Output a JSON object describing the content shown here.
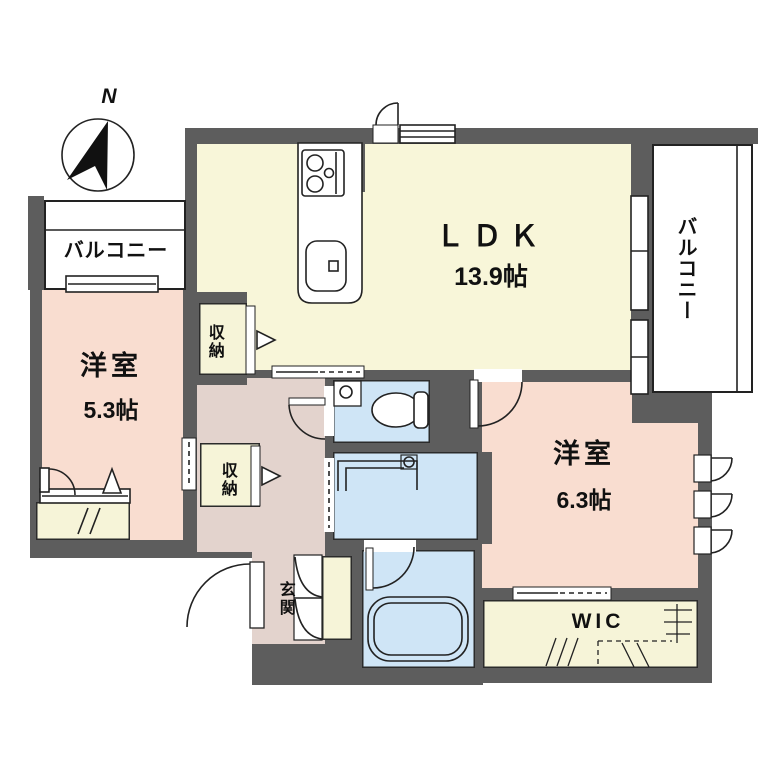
{
  "plan": {
    "title": "apartment-floor-plan",
    "compass": {
      "label": "N"
    },
    "balconies": {
      "left": "バルコニー",
      "right": "バルコニー"
    },
    "rooms": {
      "ldk": {
        "name": "ＬＤＫ",
        "size": "13.9帖"
      },
      "bedroom_small": {
        "name": "洋室",
        "size": "5.3帖"
      },
      "bedroom_large": {
        "name": "洋室",
        "size": "6.3帖"
      },
      "storage_top": {
        "label": "収納"
      },
      "storage_mid": {
        "label": "収納"
      },
      "entrance": {
        "label": "玄関"
      },
      "walk_in_closet": {
        "label": "WIC"
      }
    },
    "fixtures": [
      "compass",
      "stove",
      "kitchen-sink",
      "toilet",
      "hand-basin",
      "vanity",
      "bathtub"
    ],
    "colors": {
      "wall": "#5d5d5d",
      "ldk_floor": "#f8f6d9",
      "bedroom_floor": "#f9ddd0",
      "hall_floor": "#e3d3cd",
      "wet_floor": "#cfe5f6",
      "closet_floor": "#f6f4d8",
      "line": "#222222"
    }
  }
}
